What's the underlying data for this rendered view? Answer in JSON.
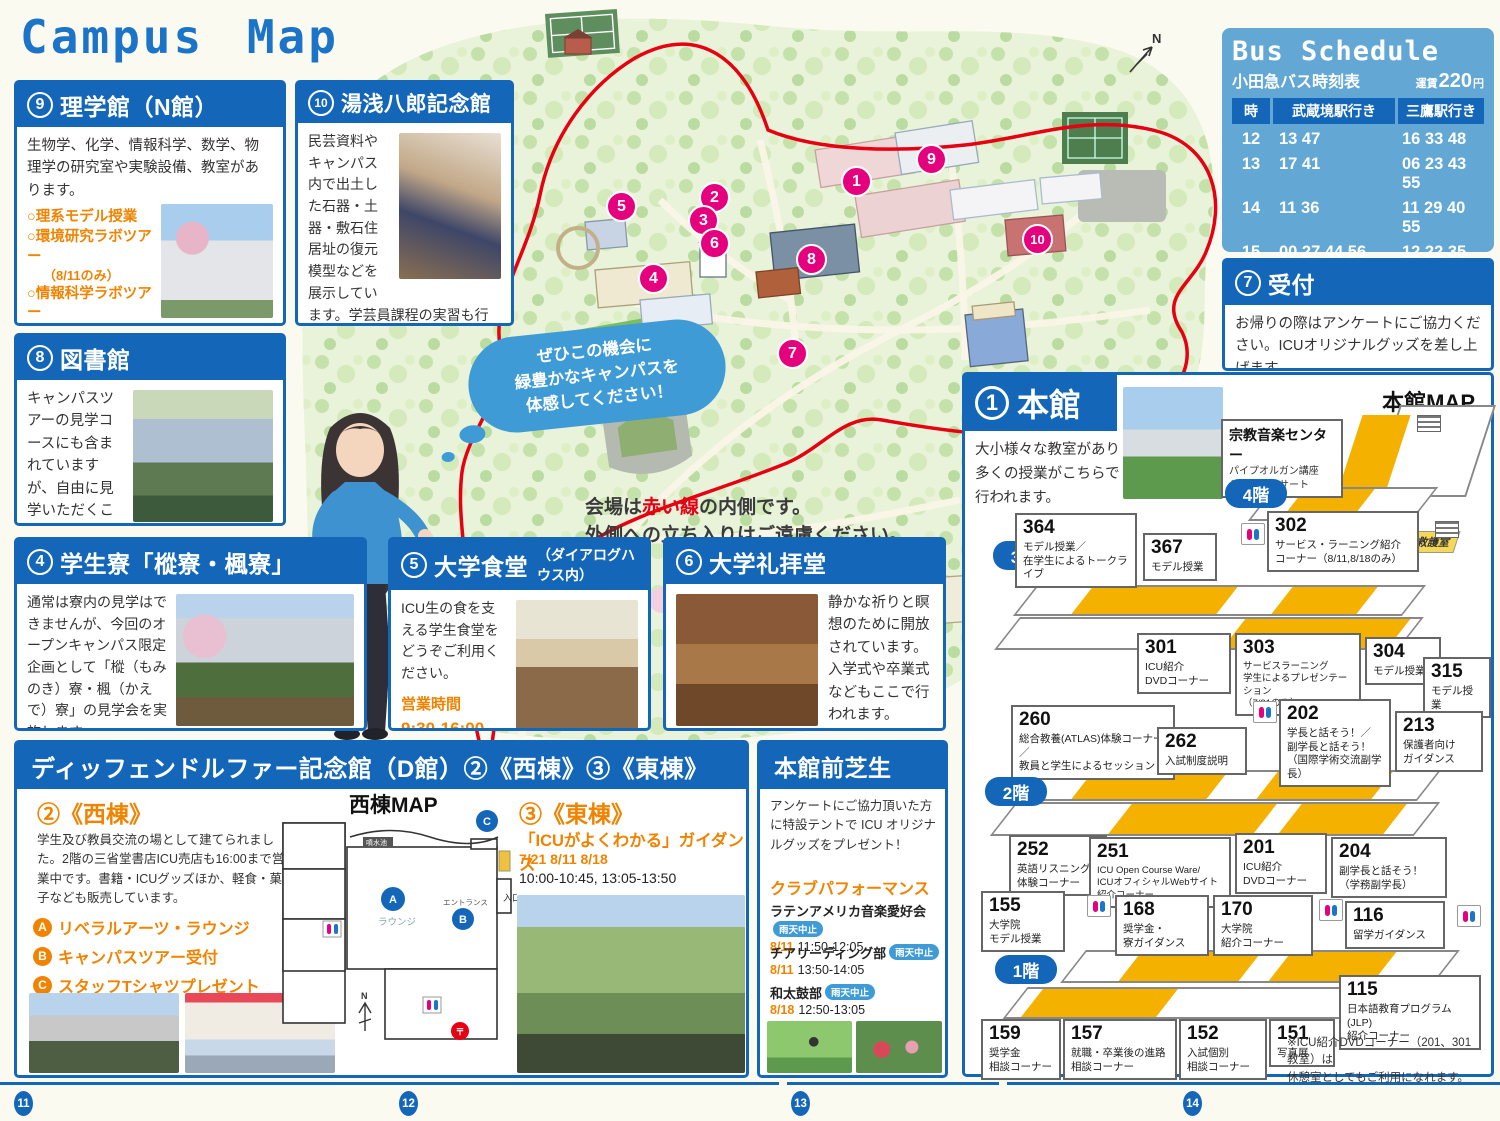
{
  "page": {
    "title": "Campus Map",
    "page_numbers": [
      "11",
      "12",
      "13",
      "14"
    ]
  },
  "bus": {
    "title": "Bus Schedule",
    "subtitle": "小田急バス時刻表",
    "fare_label": "運賃",
    "fare_value": "220",
    "fare_unit": "円",
    "col_hour": "時",
    "col_musashisakai": "武蔵境駅行き",
    "col_mitaka": "三鷹駅行き",
    "rows": [
      {
        "h": "12",
        "a": "13 47",
        "b": "16 33 48"
      },
      {
        "h": "13",
        "a": "17 41",
        "b": "06 23 43 55"
      },
      {
        "h": "14",
        "a": "11 36",
        "b": "11 29 40 55"
      },
      {
        "h": "15",
        "a": "00 27 44 56",
        "b": "12 22 35 51"
      },
      {
        "h": "16",
        "a": "11 21 32 50",
        "b": "10 23 41"
      }
    ]
  },
  "science": {
    "num": "9",
    "title": "理学館（N館）",
    "body": "生物学、化学、情報科学、数学、物理学の研究室や実験設備、教室があります。",
    "items": [
      {
        "label": "○理系モデル授業",
        "note": ""
      },
      {
        "label": "○環境研究ラボツアー",
        "note": "（8/11のみ）"
      },
      {
        "label": "○情報科学ラボツアー",
        "note": "（8/18のみ）"
      }
    ]
  },
  "yuasa": {
    "num": "10",
    "title": "湯浅八郎記念館",
    "body": "民芸資料やキャンパス内で出土した石器・土器・敷石住居址の復元模型などを展示しています。学芸員課程の実習も行われる博物館です。"
  },
  "library": {
    "num": "8",
    "title": "図書館",
    "body": "キャンパスツアーの見学コースにも含まれていますが、自由に見学いただくことも可能です。"
  },
  "dorm": {
    "num": "4",
    "title": "学生寮「樅寮・楓寮」",
    "body": "通常は寮内の見学はできませんが、今回のオープンキャンパス限定企画として「樅（もみのき）寮・楓（かえで）寮」の見学会を実施します。"
  },
  "cafeteria": {
    "num": "5",
    "title": "大学食堂",
    "title_sub": "（ダイアログハウス内）",
    "body": "ICU生の食を支える学生食堂をどうぞご利用ください。",
    "hours_label": "営業時間",
    "hours": "9:30-16:00",
    "hours_note": "（昼食は11:00-）"
  },
  "chapel": {
    "num": "6",
    "title": "大学礼拝堂",
    "body": "静かな祈りと瞑想のために開放されています。入学式や卒業式などもここで行われます。"
  },
  "reception": {
    "num": "7",
    "title": "受付",
    "body": "お帰りの際はアンケートにご協力ください。ICUオリジナルグッズを差し上げます。"
  },
  "map": {
    "bubble": "ぜひこの機会に\n緑豊かなキャンパスを\n体感してください！",
    "note_pre": "会場は",
    "note_red": "赤い線",
    "note_post": "の内側です。",
    "note_line2": "外側への立ち入りはご遠慮ください。",
    "compass": "N",
    "markers": [
      "1",
      "2",
      "3",
      "4",
      "5",
      "6",
      "7",
      "8",
      "9",
      "10"
    ]
  },
  "honkan": {
    "num": "1",
    "title": "本館",
    "desc": "大小様々な教室があり多くの授業がこちらで行われます。",
    "map_label": "本館MAP",
    "music_center": {
      "title": "宗教音楽センター",
      "line1": "パイプオルガン講座",
      "line2": "ミニ・コンサート"
    },
    "first_aid": "救護室",
    "floor4": "4階",
    "floor3": "3階",
    "floor2": "2階",
    "floor1": "1階",
    "rooms3": [
      {
        "no": "364",
        "desc": "モデル授業／\n在学生によるトークライブ"
      },
      {
        "no": "367",
        "desc": "モデル授業"
      },
      {
        "no": "302",
        "desc": "サービス・ラーニング紹介\nコーナー（8/11,8/18のみ）"
      },
      {
        "no": "301",
        "desc": "ICU紹介\nDVDコーナー"
      },
      {
        "no": "303",
        "desc": "サービスラーニング\n学生によるプレゼンテーション\n（7/21のみ）"
      },
      {
        "no": "304",
        "desc": "モデル授業"
      },
      {
        "no": "315",
        "desc": "モデル授業"
      }
    ],
    "rooms2": [
      {
        "no": "260",
        "desc": "総合教養(ATLAS)体験コーナー／\n教員と学生によるセッション"
      },
      {
        "no": "262",
        "desc": "入試制度説明"
      },
      {
        "no": "202",
        "desc": "学長と話そう！／\n副学長と話そう！\n（国際学術交流副学長）"
      },
      {
        "no": "213",
        "desc": "保護者向け\nガイダンス"
      },
      {
        "no": "252",
        "desc": "英語リスニング\n体験コーナー"
      },
      {
        "no": "251",
        "desc": "ICU Open Course Ware/\nICUオフィシャルWebサイト紹介コーナー"
      },
      {
        "no": "201",
        "desc": "ICU紹介\nDVDコーナー"
      },
      {
        "no": "204",
        "desc": "副学長と話そう！\n（学務副学長）"
      }
    ],
    "rooms1": [
      {
        "no": "155",
        "desc": "大学院\nモデル授業"
      },
      {
        "no": "168",
        "desc": "奨学金・\n寮ガイダンス"
      },
      {
        "no": "170",
        "desc": "大学院\n紹介コーナー"
      },
      {
        "no": "116",
        "desc": "留学ガイダンス"
      },
      {
        "no": "115",
        "desc": "日本語教育プログラム(JLP)\n紹介コーナー"
      },
      {
        "no": "159",
        "desc": "奨学金\n相談コーナー"
      },
      {
        "no": "157",
        "desc": "就職・卒業後の進路\n相談コーナー"
      },
      {
        "no": "152",
        "desc": "入試個別\n相談コーナー"
      },
      {
        "no": "151",
        "desc": "写真展"
      }
    ],
    "note": "※ICU紹介DVDコーナー（201、301教室）は\n休憩室としてもご利用になれます。"
  },
  "dhall": {
    "title": "ディッフェンドルファー記念館（D館）②《西棟》③《東棟》",
    "west": {
      "heading": "②《西棟》",
      "body": "学生及び教員交流の場として建てられました。2階の三省堂書店ICU売店も16:00まで営業中です。書籍・ICUグッズほか、軽食・菓子なども販売しています。",
      "items": [
        {
          "key": "A",
          "label": "リベラルアーツ・ラウンジ"
        },
        {
          "key": "B",
          "label": "キャンパスツアー受付"
        },
        {
          "key": "C",
          "label": "スタッフTシャツプレゼント"
        }
      ],
      "map_label": "西棟MAP",
      "plan": {
        "pond": "噴水池",
        "lounge": "ラウンジ",
        "entrance": "エントランス",
        "entry": "入口",
        "post": "〒",
        "north": "N",
        "a": "A",
        "b": "B",
        "c": "C"
      }
    },
    "east": {
      "heading": "③《東棟》",
      "sub": "「ICUがよくわかる」ガイダンス",
      "dates": "7/21 8/11 8/18",
      "times": "10:00-10:45, 13:05-13:50"
    }
  },
  "lawn": {
    "title": "本館前芝生",
    "body": "アンケートにご協力頂いた方に特設テントで ICU オリジナルグッズをプレゼント！",
    "club_heading": "クラブパフォーマンス",
    "badge": "雨天中止",
    "events": [
      {
        "name": "ラテンアメリカ音楽愛好会",
        "date": "8/11",
        "time": "11:50-12:05"
      },
      {
        "name": "チアリーディング部",
        "date": "8/11",
        "time": "13:50-14:05"
      },
      {
        "name": "和太鼓部",
        "date": "8/18",
        "time": "12:50-13:05"
      }
    ]
  }
}
